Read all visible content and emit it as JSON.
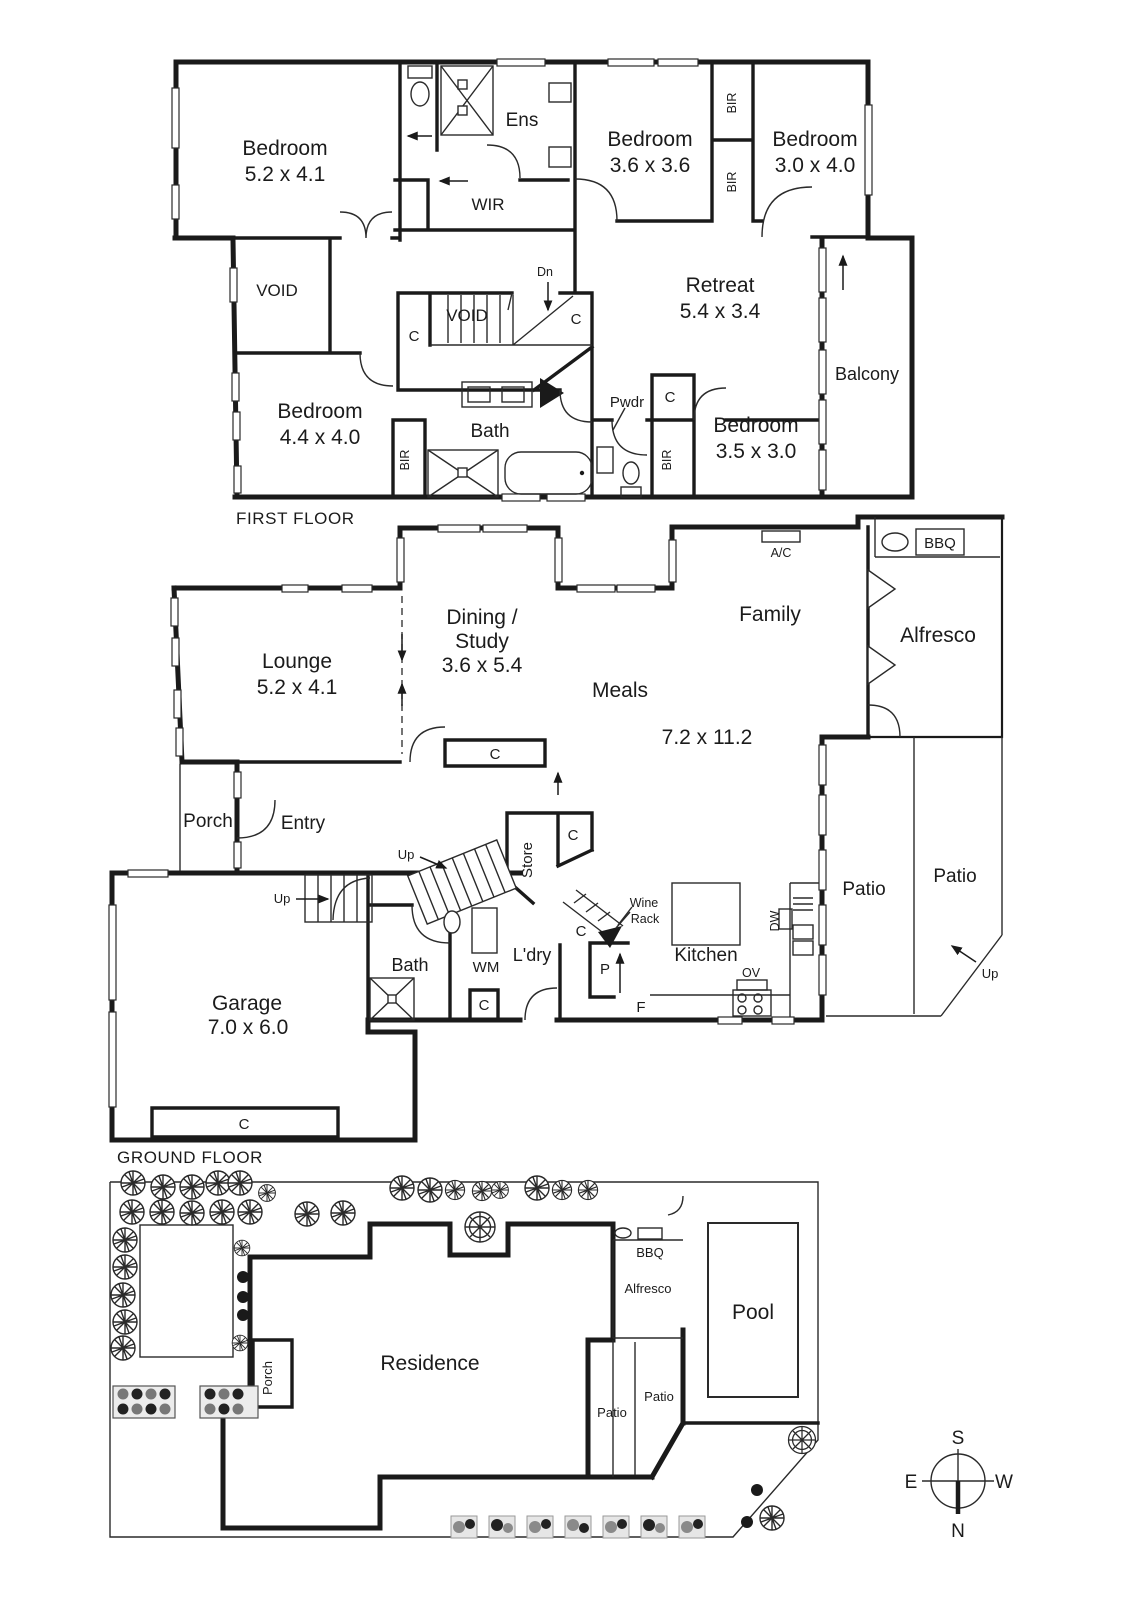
{
  "meta": {
    "background": "#ffffff",
    "ink": "#1a1a1a"
  },
  "first_floor": {
    "title": "FIRST FLOOR",
    "bedroom1": {
      "name": "Bedroom",
      "dims": "5.2 x 4.1"
    },
    "bedroom2": {
      "name": "Bedroom",
      "dims": "3.6 x 3.6"
    },
    "bedroom3": {
      "name": "Bedroom",
      "dims": "3.0 x 4.0"
    },
    "bedroom4": {
      "name": "Bedroom",
      "dims": "4.4 x 4.0"
    },
    "bedroom5": {
      "name": "Bedroom",
      "dims": "3.5 x 3.0"
    },
    "retreat": {
      "name": "Retreat",
      "dims": "5.4 x 3.4"
    },
    "ens": "Ens",
    "wir": "WIR",
    "void1": "VOID",
    "void2": "VOID",
    "dn": "Dn",
    "bath": "Bath",
    "pwdr": "Pwdr",
    "balcony": "Balcony",
    "bir1": "BIR",
    "bir2": "BIR",
    "bir3": "BIR",
    "bir4": "BIR",
    "c1": "C",
    "c2": "C",
    "c3": "C"
  },
  "ground_floor": {
    "title": "GROUND FLOOR",
    "lounge": {
      "name": "Lounge",
      "dims": "5.2 x 4.1"
    },
    "dining": {
      "line1": "Dining /",
      "line2": "Study",
      "dims": "3.6 x 5.4"
    },
    "meals": {
      "name": "Meals",
      "dims": "7.2 x 11.2"
    },
    "family": "Family",
    "alfresco": "Alfresco",
    "bbq": "BBQ",
    "ac": "A/C",
    "porch": "Porch",
    "entry": "Entry",
    "store": "Store",
    "bath": "Bath",
    "wm": "WM",
    "ldry": "L'dry",
    "wine_rack": {
      "line1": "Wine",
      "line2": "Rack"
    },
    "kitchen": "Kitchen",
    "pantry": "P",
    "fridge": "F",
    "oven": "OV",
    "dw": "DW",
    "patio1": "Patio",
    "patio2": "Patio",
    "garage": {
      "name": "Garage",
      "dims": "7.0 x 6.0"
    },
    "up1": "Up",
    "up2": "Up",
    "up3": "Up",
    "c1": "C",
    "c2": "C",
    "c3": "C",
    "c4": "C",
    "c5": "C"
  },
  "site_plan": {
    "residence": "Residence",
    "porch": "Porch",
    "bbq": "BBQ",
    "alfresco": "Alfresco",
    "pool": "Pool",
    "patio1": "Patio",
    "patio2": "Patio",
    "compass": {
      "n": "N",
      "s": "S",
      "e": "E",
      "w": "W"
    }
  }
}
